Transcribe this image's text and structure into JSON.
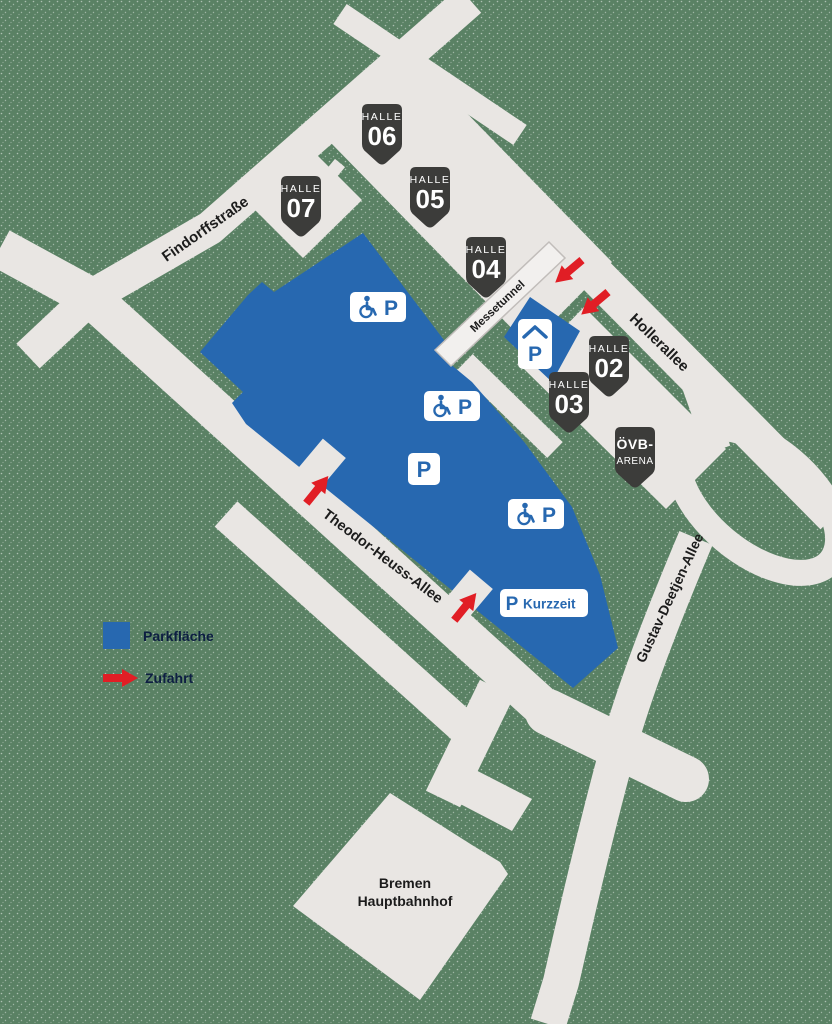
{
  "map_title": "Messe Bremen Parkplan",
  "streets": {
    "findorffstrasse": "Findorffstraße",
    "theodor_heuss_allee": "Theodor-Heuss-Allee",
    "hollerallee": "Hollerallee",
    "gustav_deetjen_allee": "Gustav-Deetjen-Allee",
    "messetunnel": "Messetunnel"
  },
  "halls": [
    {
      "label": "HALLE",
      "number": "06"
    },
    {
      "label": "HALLE",
      "number": "07"
    },
    {
      "label": "HALLE",
      "number": "05"
    },
    {
      "label": "HALLE",
      "number": "04"
    },
    {
      "label": "HALLE",
      "number": "02"
    },
    {
      "label": "HALLE",
      "number": "03"
    }
  ],
  "arena": {
    "line1": "ÖVB-",
    "line2": "ARENA"
  },
  "station": {
    "line1": "Bremen",
    "line2": "Hauptbahnhof"
  },
  "parking": {
    "p": "P",
    "kurzzeit": "Kurzzeit"
  },
  "legend": {
    "parkflaeche": "Parkfläche",
    "zufahrt": "Zufahrt"
  },
  "colors": {
    "parking_blue": "#2768b0",
    "road_gray": "#e9e6e3",
    "background_green": "#5a8164",
    "arrow_red": "#e11e25",
    "badge_dark": "#3c3c3a",
    "tunnel_fill": "#f2f0ee"
  }
}
